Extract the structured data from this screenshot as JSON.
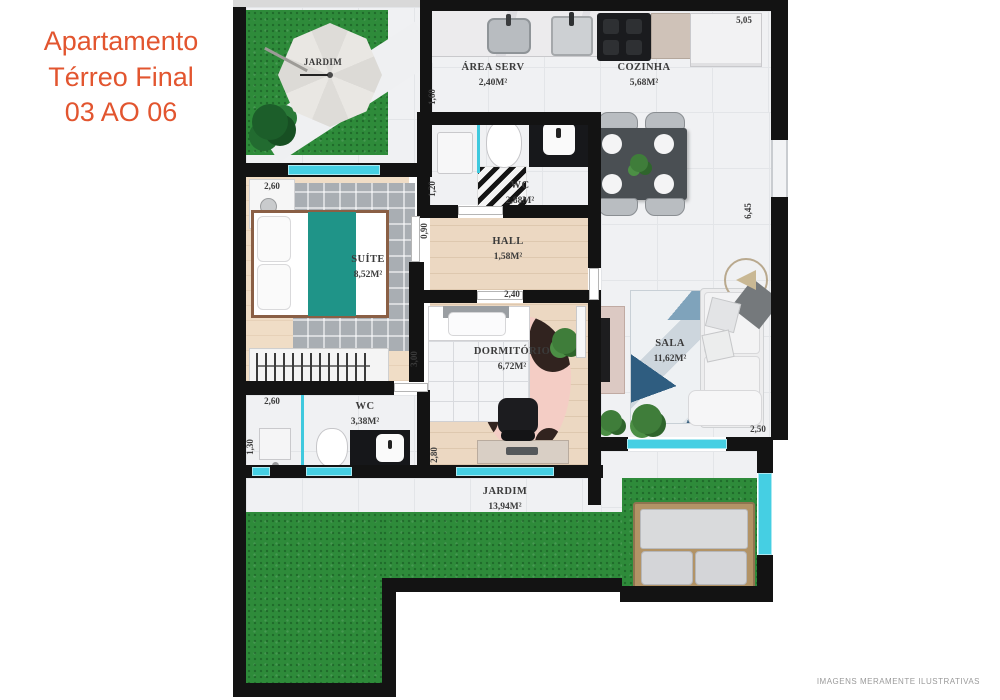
{
  "title": {
    "lines": [
      "Apartamento",
      "Térreo Final",
      "03 AO 06"
    ]
  },
  "rooms": {
    "jardim_top": {
      "name": "JARDIM"
    },
    "area_serv": {
      "name": "ÁREA SERV",
      "area": "2,40M²"
    },
    "cozinha": {
      "name": "COZINHA",
      "area": "5,68M²"
    },
    "wc_suite": {
      "name": "WC",
      "area": "2,88M²"
    },
    "hall": {
      "name": "HALL",
      "area": "1,58M²"
    },
    "suite": {
      "name": "SUÍTE",
      "area": "8,52M²"
    },
    "dormitorio": {
      "name": "DORMITÓRIO",
      "area": "6,72M²"
    },
    "sala": {
      "name": "SALA",
      "area": "11,62M²"
    },
    "wc_social": {
      "name": "WC",
      "area": "3,38M²"
    },
    "jardim_bottom": {
      "name": "JARDIM",
      "area": "13,94M²"
    }
  },
  "measurements": {
    "kitchen_top": "5,05",
    "right_wall": "6,45",
    "area_serv_left": "1,60",
    "wc_suite_left": "1,20",
    "hall_left": "0,90",
    "suite_head": "2,60",
    "suite_right": "3,00",
    "dorm_top": "2,40",
    "dorm_left": "2,80",
    "wc_social_top": "2,60",
    "wc_social_left": "1,30",
    "sala_bottom": "2,50"
  },
  "disclaimer": "IMAGENS MERAMENTE ILUSTRATIVAS",
  "colors": {
    "title": "#e2552f",
    "walls": "#131313",
    "windows": "#45cfe3",
    "grass": "#2e8b3a",
    "wood_floor": "#ecd8c2",
    "bed_runner": "#1f9488"
  }
}
